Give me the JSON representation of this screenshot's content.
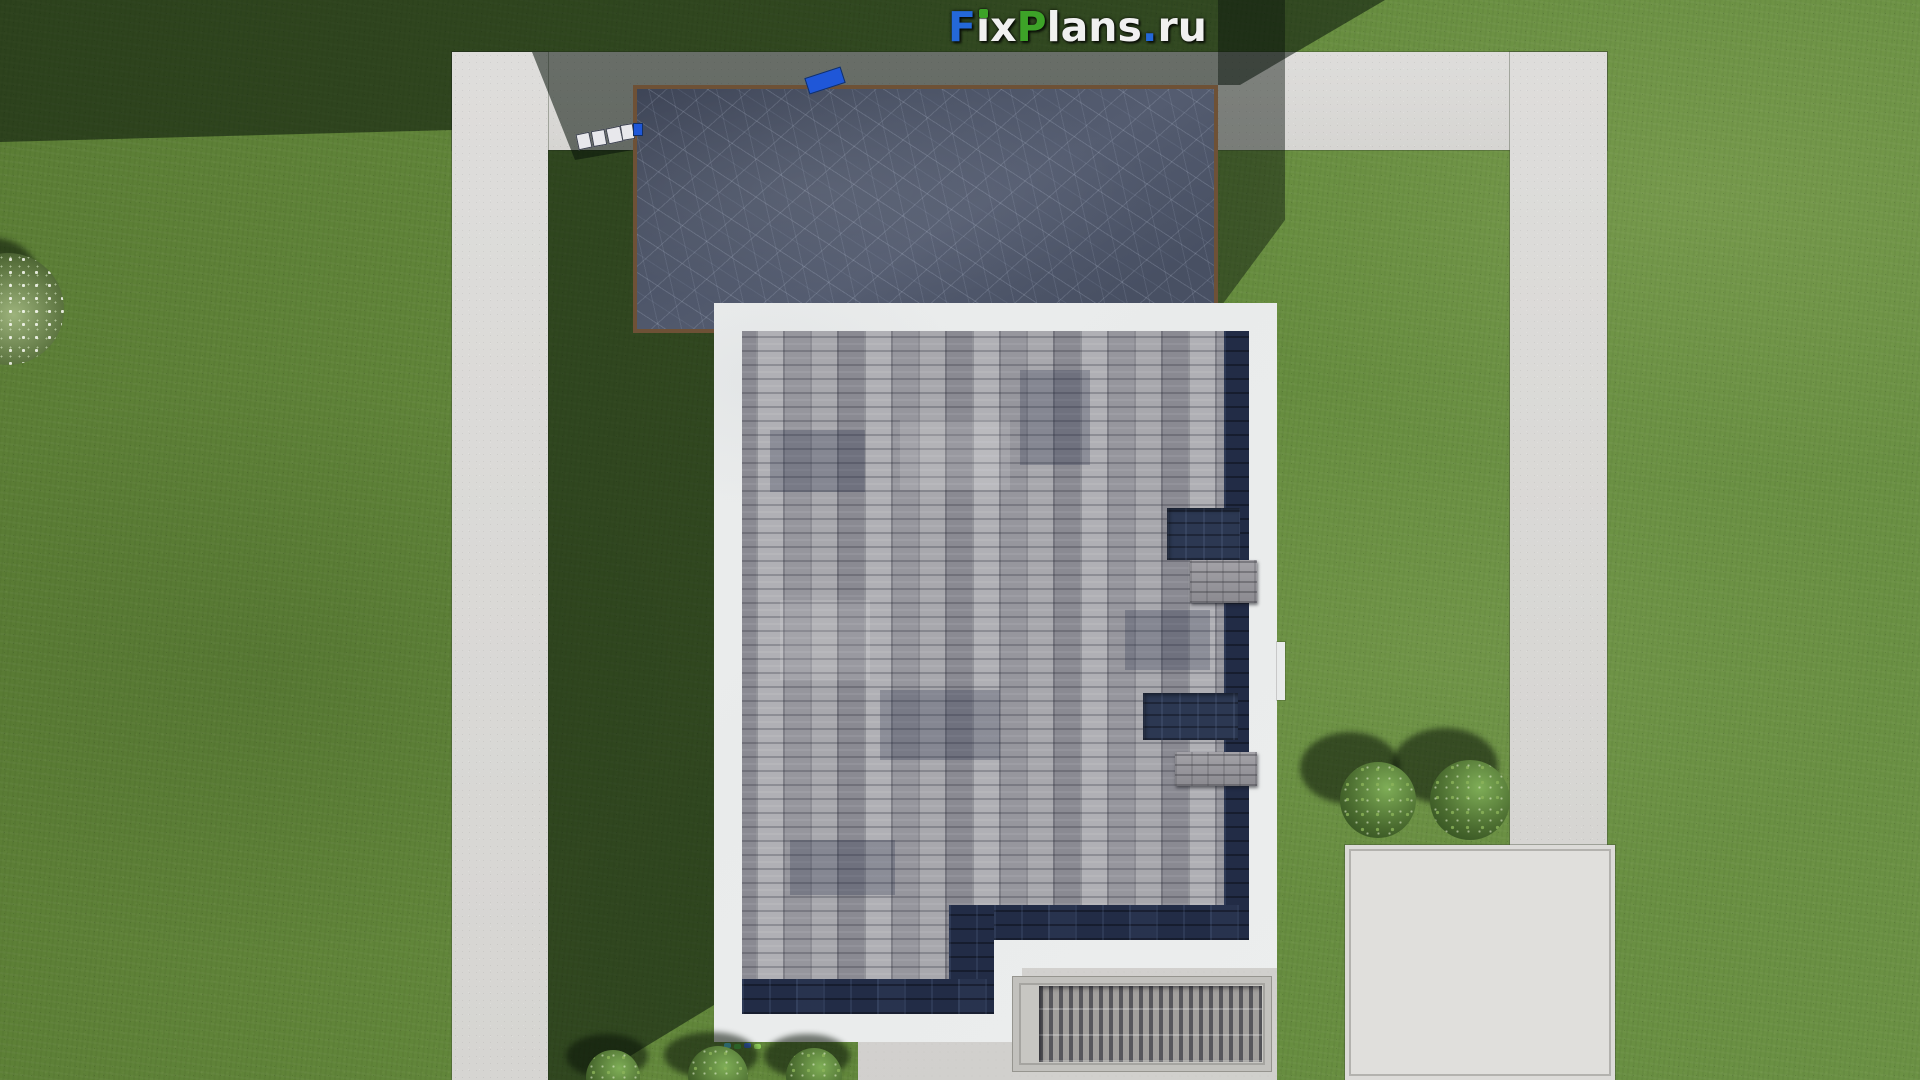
{
  "logo": {
    "text": "FixPlans.ru",
    "segments": [
      {
        "text": "F",
        "color": "#2468d8"
      },
      {
        "text": "ix",
        "color": "#f0f0f0"
      },
      {
        "text": "P",
        "color": "#3da328"
      },
      {
        "text": "lans",
        "color": "#f0f0f0"
      },
      {
        "text": ".",
        "color": "#2468d8"
      },
      {
        "text": "ru",
        "color": "#f0f0f0"
      }
    ],
    "i_dot_color": "#3da328"
  },
  "colors": {
    "grass": "#63863b",
    "grass_shadow": "rgba(8,18,10,0.55)",
    "path_concrete": "#dbdad8",
    "pad_concrete": "#e0dfdc",
    "garage_roof_slate": "#4c5467",
    "garage_trim_brown": "#6e5136",
    "house_parapet_white": "#eef0f0",
    "shingles_gray": "#a2a2a8",
    "shingle_border_navy": "#222c46",
    "roof_vent_navy": "#2c3852",
    "chimney_gray": "#96959a",
    "terrace_concrete": "#d5d4d1",
    "grate_rib_dark": "#57575c",
    "blue_object": "#1f57d8",
    "bush_green": "#4a6b2f"
  }
}
